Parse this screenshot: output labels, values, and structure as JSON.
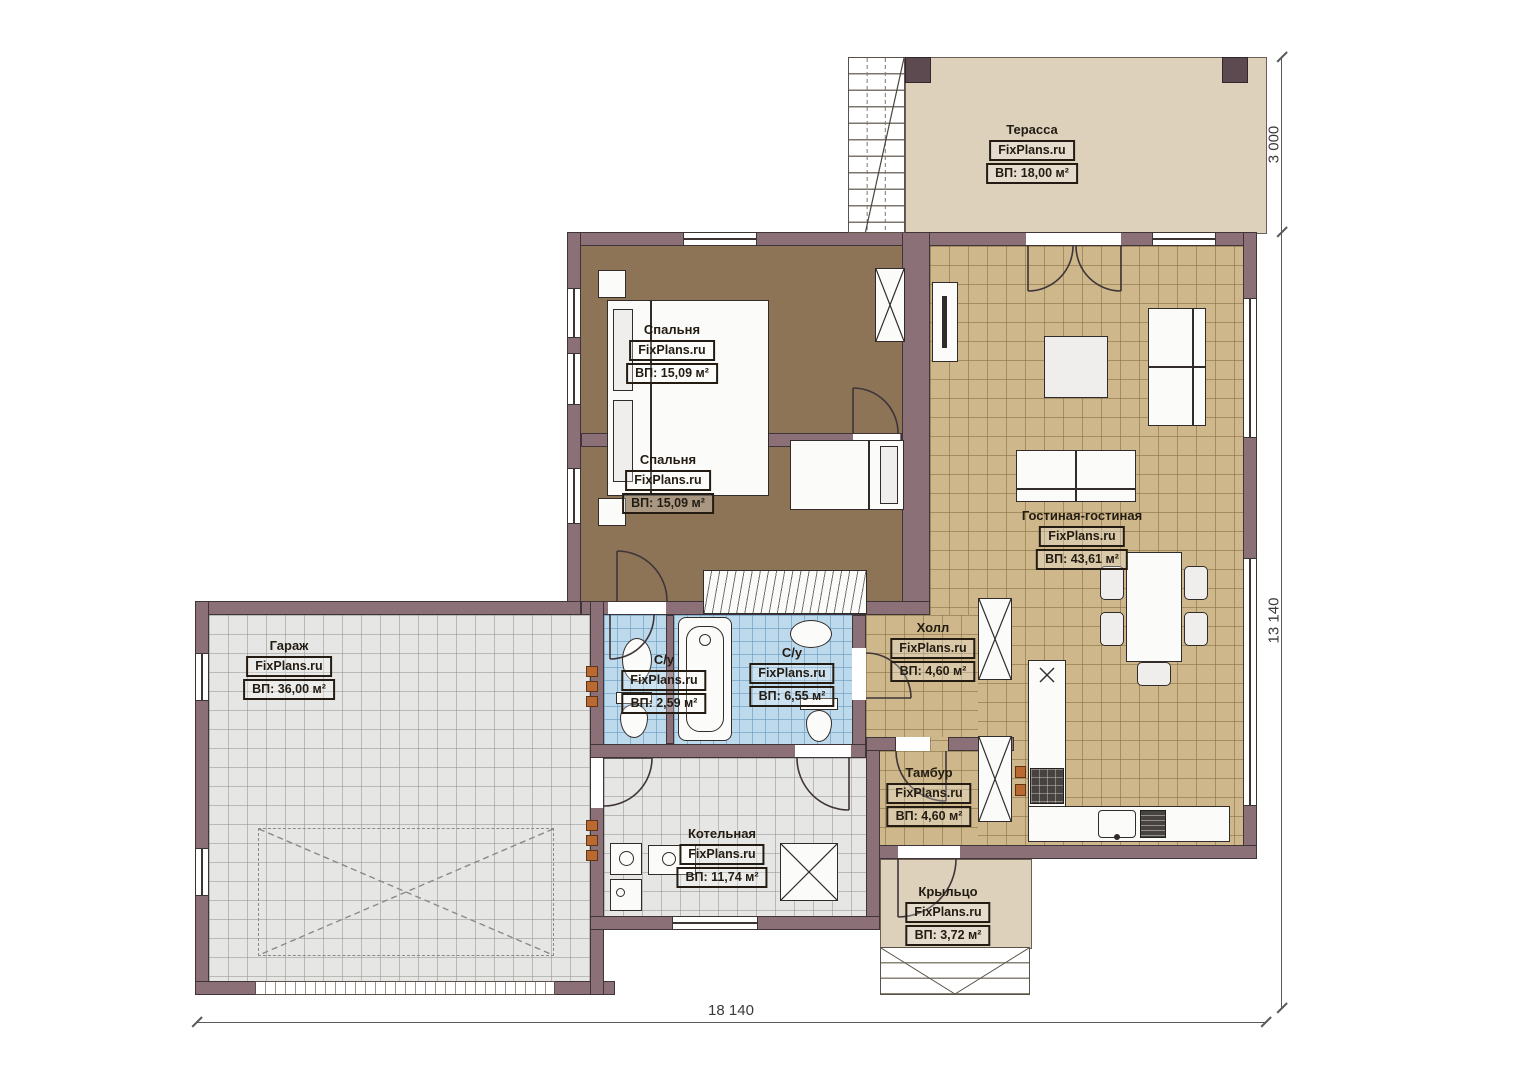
{
  "brand": "FixPlans.ru",
  "rooms": {
    "terrace": {
      "name": "Терасса",
      "area": "ВП: 18,00 м²"
    },
    "bedroom1": {
      "name": "Спальня",
      "area": "ВП: 15,09 м²"
    },
    "bedroom2": {
      "name": "Спальня",
      "area": "ВП: 15,09 м²"
    },
    "living": {
      "name": "Гостиная-гостиная",
      "area": "ВП: 43,61 м²"
    },
    "hall": {
      "name": "Холл",
      "area": "ВП: 4,60 м²"
    },
    "wc": {
      "name": "С/у",
      "area": "ВП: 2,59 м²"
    },
    "bathroom": {
      "name": "С/у",
      "area": "ВП: 6,55 м²"
    },
    "garage": {
      "name": "Гараж",
      "area": "ВП: 36,00 м²"
    },
    "tambur": {
      "name": "Тамбур",
      "area": "ВП: 4,60 м²"
    },
    "boiler": {
      "name": "Котельная",
      "area": "ВП: 11,74 м²"
    },
    "porch": {
      "name": "Крыльцо",
      "area": "ВП: 3,72 м²"
    }
  },
  "dimensions": {
    "total_width": "18 140",
    "total_height": "13 140",
    "terrace_depth": "3 000"
  },
  "colors": {
    "wall": "#8b7078",
    "wall_dark": "#3f3539",
    "bedroom_floor": "#8d7457",
    "tile_tan": "#cdb78b",
    "tile_blue": "#bdd9ec",
    "tile_gray": "#e6e6e4",
    "terrace": "#ddd1bc",
    "accent_orange": "#b96a33"
  }
}
